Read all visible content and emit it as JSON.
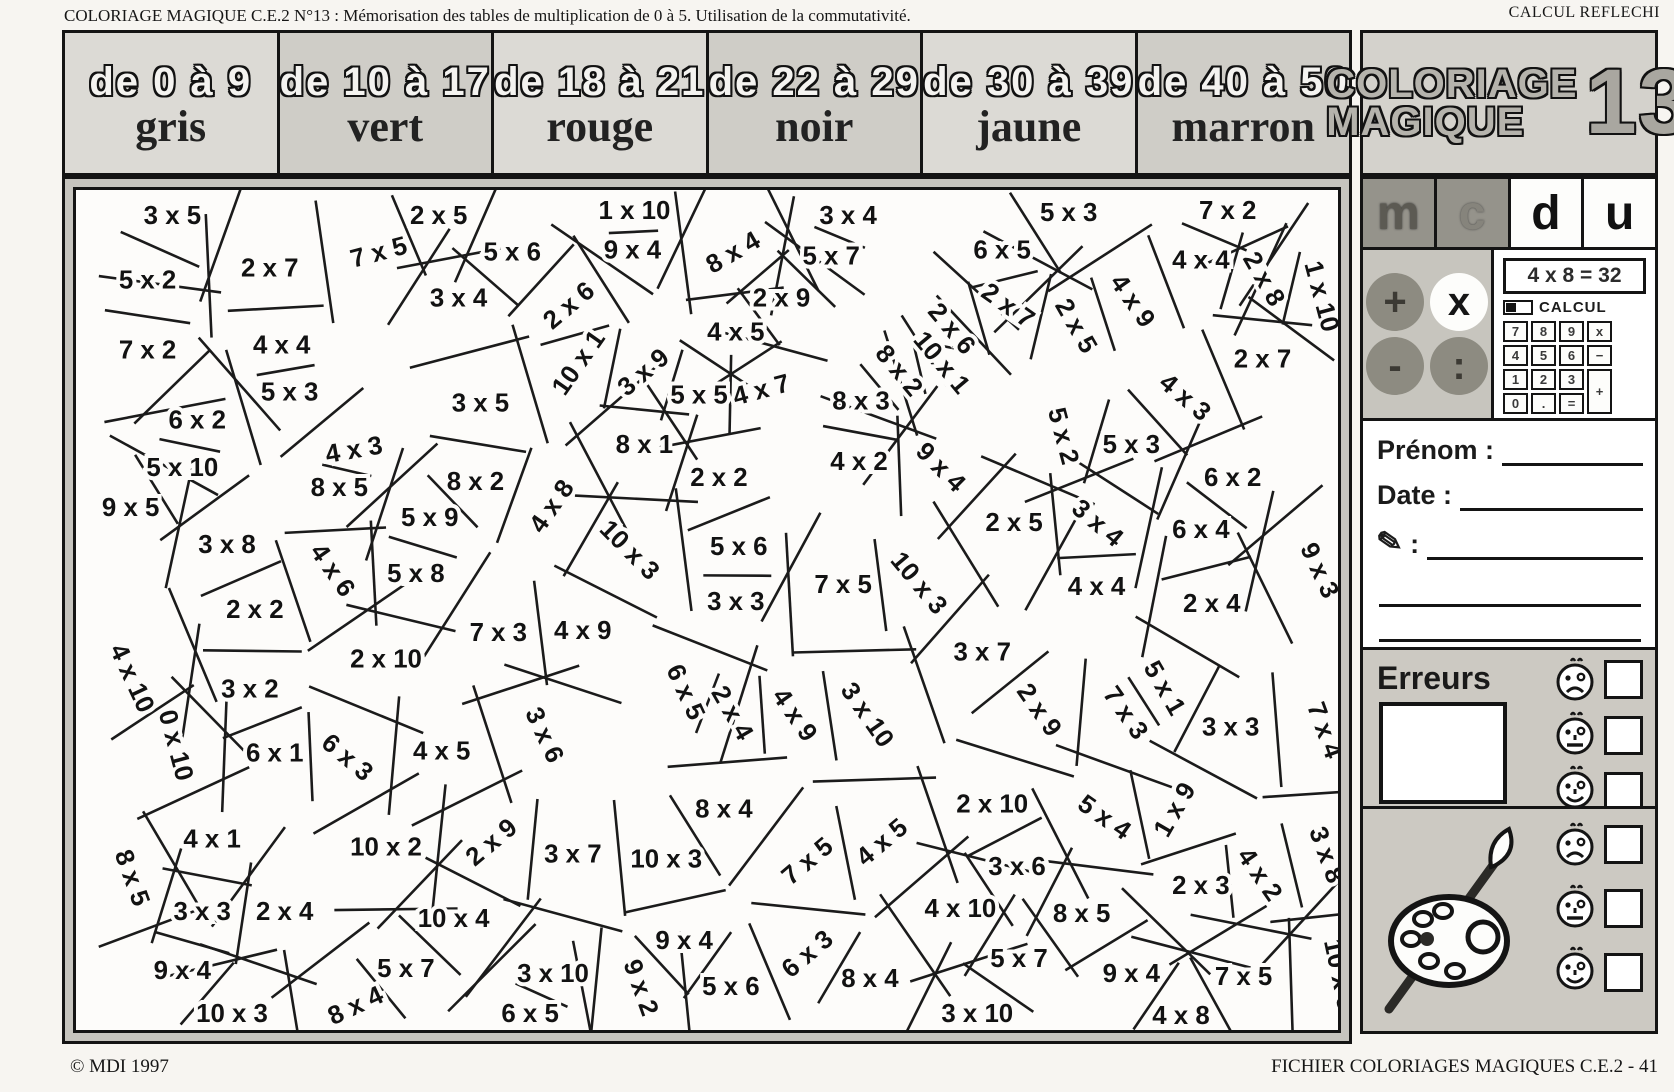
{
  "colors": {
    "paper": "#f7f5f1",
    "panel_gray": "#ccc9c2",
    "ink": "#141414"
  },
  "header": {
    "left": "COLORIAGE MAGIQUE C.E.2  N°13 : Mémorisation des tables de multiplication de 0 à 5. Utilisation de la commutativité.",
    "right": "CALCUL REFLECHI"
  },
  "legend": {
    "cells": [
      {
        "range": "de 0 à 9",
        "color_name": "gris"
      },
      {
        "range": "de 10 à 17",
        "color_name": "vert"
      },
      {
        "range": "de 18 à 21",
        "color_name": "rouge"
      },
      {
        "range": "de 22 à 29",
        "color_name": "noir"
      },
      {
        "range": "de 30 à 39",
        "color_name": "jaune"
      },
      {
        "range": "de 40 à 50",
        "color_name": "marron"
      }
    ]
  },
  "logo": {
    "line1": "COLORIAGE",
    "line2": "MAGIQUE",
    "number": "13"
  },
  "place_value_letters": [
    "m",
    "c",
    "d",
    "u"
  ],
  "operations": [
    "+",
    "x",
    "-",
    ":"
  ],
  "calculator": {
    "display": "4 x 8 = 32",
    "brand": "CALCUL",
    "keys": [
      "7",
      "8",
      "9",
      "x",
      "4",
      "5",
      "6",
      "−",
      "1",
      "2",
      "3",
      "0",
      ".",
      "="
    ],
    "plus_key": "+"
  },
  "identity": {
    "prenom_label": "Prénom :",
    "date_label": "Date :",
    "pencil_label": ":"
  },
  "erreurs": {
    "title": "Erreurs"
  },
  "footer": {
    "left": "© MDI 1997",
    "right": "FICHIER COLORIAGES MAGIQUES C.E.2  -  41"
  },
  "puzzle": {
    "labels": [
      {
        "t": "3 x 5",
        "x": 175,
        "y": 205
      },
      {
        "t": "2 x 5",
        "x": 443,
        "y": 205
      },
      {
        "t": "1 x 10",
        "x": 640,
        "y": 200
      },
      {
        "t": "3 x 4",
        "x": 855,
        "y": 205
      },
      {
        "t": "5 x 3",
        "x": 1077,
        "y": 202
      },
      {
        "t": "7 x 2",
        "x": 1237,
        "y": 200
      },
      {
        "t": "5 x 2",
        "x": 150,
        "y": 270
      },
      {
        "t": "2 x 7",
        "x": 273,
        "y": 258
      },
      {
        "t": "7 x 5",
        "x": 383,
        "y": 242,
        "r": -15
      },
      {
        "t": "5 x 6",
        "x": 517,
        "y": 242
      },
      {
        "t": "9 x 4",
        "x": 638,
        "y": 240
      },
      {
        "t": "8 x 4",
        "x": 740,
        "y": 242,
        "r": -30
      },
      {
        "t": "5 x 7",
        "x": 838,
        "y": 246
      },
      {
        "t": "6 x 5",
        "x": 1010,
        "y": 240
      },
      {
        "t": "4 x 4",
        "x": 1210,
        "y": 250
      },
      {
        "t": "2 x 8",
        "x": 1272,
        "y": 268,
        "r": 60
      },
      {
        "t": "1 x 10",
        "x": 1330,
        "y": 285,
        "r": 75
      },
      {
        "t": "7 x 2",
        "x": 150,
        "y": 340
      },
      {
        "t": "4 x 4",
        "x": 285,
        "y": 335
      },
      {
        "t": "3 x 4",
        "x": 463,
        "y": 288
      },
      {
        "t": "2 x 6",
        "x": 575,
        "y": 295,
        "r": -40
      },
      {
        "t": "2 x 9",
        "x": 788,
        "y": 288
      },
      {
        "t": "2 x 7",
        "x": 1015,
        "y": 295,
        "r": 35
      },
      {
        "t": "4 x 9",
        "x": 1140,
        "y": 290,
        "r": 55
      },
      {
        "t": "2 x 7",
        "x": 1272,
        "y": 349
      },
      {
        "t": "5 x 3",
        "x": 293,
        "y": 382
      },
      {
        "t": "3 x 5",
        "x": 485,
        "y": 393
      },
      {
        "t": "10 x 1",
        "x": 585,
        "y": 352,
        "r": -55
      },
      {
        "t": "3 x 9",
        "x": 650,
        "y": 362,
        "r": -40
      },
      {
        "t": "4 x 5",
        "x": 742,
        "y": 322
      },
      {
        "t": "2 x 5",
        "x": 1083,
        "y": 315,
        "r": 60
      },
      {
        "t": "4 x 3",
        "x": 1193,
        "y": 387,
        "r": 40
      },
      {
        "t": "6 x 2",
        "x": 200,
        "y": 410
      },
      {
        "t": "5 x 5",
        "x": 705,
        "y": 385
      },
      {
        "t": "4 x 7",
        "x": 768,
        "y": 380,
        "r": -15
      },
      {
        "t": "8 x 3",
        "x": 868,
        "y": 391
      },
      {
        "t": "8 x 2",
        "x": 905,
        "y": 360,
        "r": 50
      },
      {
        "t": "10 x 1",
        "x": 948,
        "y": 352,
        "r": 50
      },
      {
        "t": "2 x 6",
        "x": 958,
        "y": 318,
        "r": 50
      },
      {
        "t": "8 x 1",
        "x": 650,
        "y": 435
      },
      {
        "t": "4 x 3",
        "x": 358,
        "y": 440,
        "r": -10
      },
      {
        "t": "8 x 2",
        "x": 480,
        "y": 472
      },
      {
        "t": "4 x 8",
        "x": 558,
        "y": 496,
        "r": -55
      },
      {
        "t": "2 x 2",
        "x": 725,
        "y": 468
      },
      {
        "t": "4 x 2",
        "x": 866,
        "y": 452
      },
      {
        "t": "9 x 4",
        "x": 947,
        "y": 457,
        "r": 45
      },
      {
        "t": "5 x 2",
        "x": 1070,
        "y": 425,
        "r": 75
      },
      {
        "t": "5 x 3",
        "x": 1140,
        "y": 435
      },
      {
        "t": "6 x 2",
        "x": 1242,
        "y": 468
      },
      {
        "t": "9 x 3",
        "x": 1328,
        "y": 560,
        "r": 65
      },
      {
        "t": "5 x 10",
        "x": 185,
        "y": 458
      },
      {
        "t": "8 x 5",
        "x": 343,
        "y": 478
      },
      {
        "t": "9 x 5",
        "x": 133,
        "y": 498
      },
      {
        "t": "3 x 8",
        "x": 230,
        "y": 535
      },
      {
        "t": "4 x 6",
        "x": 335,
        "y": 560,
        "r": 55
      },
      {
        "t": "5 x 9",
        "x": 434,
        "y": 508
      },
      {
        "t": "5 x 8",
        "x": 420,
        "y": 564
      },
      {
        "t": "10 x 3",
        "x": 634,
        "y": 540,
        "r": 45
      },
      {
        "t": "4 x 9",
        "x": 588,
        "y": 621
      },
      {
        "t": "7 x 3",
        "x": 503,
        "y": 623
      },
      {
        "t": "2 x 2",
        "x": 258,
        "y": 600
      },
      {
        "t": "2 x 10",
        "x": 390,
        "y": 650
      },
      {
        "t": "3 x 2",
        "x": 253,
        "y": 680
      },
      {
        "t": "4 x 10",
        "x": 133,
        "y": 668,
        "r": 65
      },
      {
        "t": "0 x 10",
        "x": 177,
        "y": 735,
        "r": 75
      },
      {
        "t": "6 x 1",
        "x": 278,
        "y": 744
      },
      {
        "t": "6 x 3",
        "x": 350,
        "y": 748,
        "r": 40
      },
      {
        "t": "5 x 6",
        "x": 745,
        "y": 537
      },
      {
        "t": "7 x 5",
        "x": 850,
        "y": 575
      },
      {
        "t": "3 x 3",
        "x": 742,
        "y": 592
      },
      {
        "t": "10 x 3",
        "x": 925,
        "y": 573,
        "r": 50
      },
      {
        "t": "6 x 5",
        "x": 690,
        "y": 682,
        "r": 65
      },
      {
        "t": "2 x 4",
        "x": 737,
        "y": 703,
        "r": 60
      },
      {
        "t": "4 x 9",
        "x": 800,
        "y": 705,
        "r": 55
      },
      {
        "t": "3 x 10",
        "x": 873,
        "y": 705,
        "r": 55
      },
      {
        "t": "3 x 7",
        "x": 990,
        "y": 643
      },
      {
        "t": "2 x 9",
        "x": 1046,
        "y": 700,
        "r": 55
      },
      {
        "t": "7 x 3",
        "x": 1133,
        "y": 703,
        "r": 55
      },
      {
        "t": "5 x 1",
        "x": 1172,
        "y": 678,
        "r": 60
      },
      {
        "t": "3 x 3",
        "x": 1240,
        "y": 718
      },
      {
        "t": "7 x 4",
        "x": 1333,
        "y": 720,
        "r": 70
      },
      {
        "t": "3 x 4",
        "x": 1105,
        "y": 513,
        "r": 40
      },
      {
        "t": "6 x 4",
        "x": 1210,
        "y": 520
      },
      {
        "t": "4 x 4",
        "x": 1105,
        "y": 577
      },
      {
        "t": "2 x 4",
        "x": 1221,
        "y": 594
      },
      {
        "t": "2 x 5",
        "x": 1022,
        "y": 513
      },
      {
        "t": "4 x 1",
        "x": 215,
        "y": 830
      },
      {
        "t": "8 x 5",
        "x": 133,
        "y": 868,
        "r": 70
      },
      {
        "t": "3 x 3",
        "x": 205,
        "y": 903
      },
      {
        "t": "2 x 4",
        "x": 288,
        "y": 903
      },
      {
        "t": "4 x 5",
        "x": 446,
        "y": 742
      },
      {
        "t": "2 x 9",
        "x": 497,
        "y": 833,
        "r": -40
      },
      {
        "t": "3 x 6",
        "x": 548,
        "y": 725,
        "r": 65
      },
      {
        "t": "10 x 2",
        "x": 390,
        "y": 838
      },
      {
        "t": "3 x 7",
        "x": 578,
        "y": 845
      },
      {
        "t": "10 x 3",
        "x": 672,
        "y": 850
      },
      {
        "t": "8 x 4",
        "x": 730,
        "y": 800
      },
      {
        "t": "7 x 5",
        "x": 815,
        "y": 852,
        "r": -40
      },
      {
        "t": "4 x 5",
        "x": 890,
        "y": 833,
        "r": -40
      },
      {
        "t": "2 x 10",
        "x": 1000,
        "y": 795
      },
      {
        "t": "5 x 4",
        "x": 1112,
        "y": 808,
        "r": 35
      },
      {
        "t": "1 x 9",
        "x": 1185,
        "y": 800,
        "r": -60
      },
      {
        "t": "3 x 6",
        "x": 1025,
        "y": 858
      },
      {
        "t": "2 x 3",
        "x": 1210,
        "y": 877
      },
      {
        "t": "4 x 2",
        "x": 1268,
        "y": 865,
        "r": 55
      },
      {
        "t": "3 x 8",
        "x": 1335,
        "y": 845,
        "r": 70
      },
      {
        "t": "10 x 4",
        "x": 458,
        "y": 910
      },
      {
        "t": "4 x 10",
        "x": 968,
        "y": 900
      },
      {
        "t": "8 x 5",
        "x": 1090,
        "y": 905
      },
      {
        "t": "9 x 4",
        "x": 690,
        "y": 932
      },
      {
        "t": "6 x 3",
        "x": 815,
        "y": 945,
        "r": -40
      },
      {
        "t": "9 x 4",
        "x": 185,
        "y": 962
      },
      {
        "t": "5 x 7",
        "x": 410,
        "y": 960
      },
      {
        "t": "3 x 10",
        "x": 558,
        "y": 965
      },
      {
        "t": "9 x 2",
        "x": 645,
        "y": 978,
        "r": 70
      },
      {
        "t": "5 x 6",
        "x": 737,
        "y": 978
      },
      {
        "t": "8 x 4",
        "x": 877,
        "y": 970
      },
      {
        "t": "5 x 7",
        "x": 1027,
        "y": 950
      },
      {
        "t": "9 x 4",
        "x": 1140,
        "y": 965
      },
      {
        "t": "7 x 5",
        "x": 1253,
        "y": 968
      },
      {
        "t": "10 x 5",
        "x": 1348,
        "y": 965,
        "r": 78
      },
      {
        "t": "10 x 3",
        "x": 235,
        "y": 1005
      },
      {
        "t": "8 x 4",
        "x": 360,
        "y": 997,
        "r": -25
      },
      {
        "t": "6 x 5",
        "x": 535,
        "y": 1005
      },
      {
        "t": "3 x 10",
        "x": 985,
        "y": 1005
      },
      {
        "t": "4 x 8",
        "x": 1190,
        "y": 1007
      }
    ]
  }
}
